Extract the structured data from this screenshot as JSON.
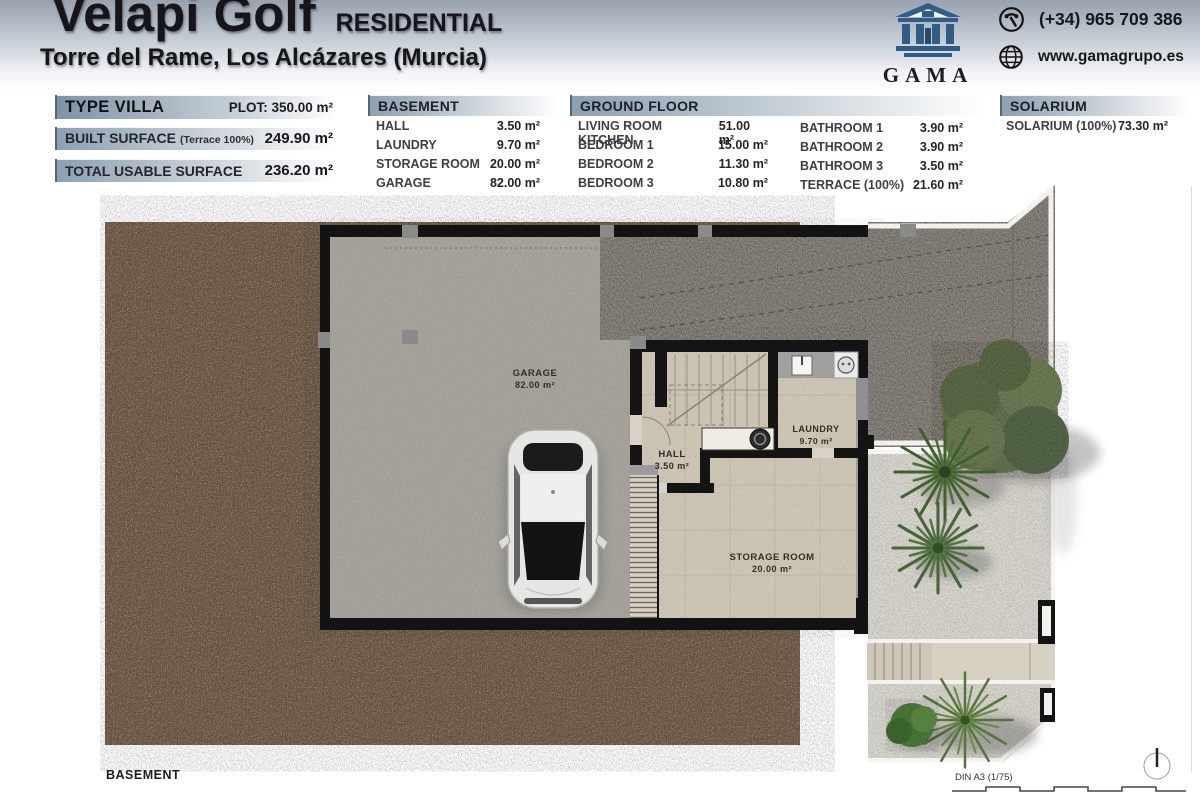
{
  "header": {
    "title": "Velapi Golf",
    "residential": "RESIDENTIAL",
    "subtitle": "Torre del Rame, Los Alcázares (Murcia)",
    "logo_text": "GAMA",
    "phone": "(+34) 965 709 386",
    "website": "www.gamagrupo.es"
  },
  "summary": {
    "type": "TYPE VILLA",
    "plot": "PLOT: 350.00 m²",
    "built_label": "BUILT SURFACE",
    "built_note": "(Terrace 100%)",
    "built_value": "249.90 m²",
    "usable_label": "TOTAL USABLE SURFACE",
    "usable_value": "236.20 m²"
  },
  "basement_table": {
    "title": "BASEMENT",
    "rows": [
      {
        "label": "HALL",
        "value": "3.50 m²"
      },
      {
        "label": "LAUNDRY",
        "value": "9.70 m²"
      },
      {
        "label": "STORAGE ROOM",
        "value": "20.00 m²"
      },
      {
        "label": "GARAGE",
        "value": "82.00 m²"
      }
    ]
  },
  "ground_table": {
    "title": "GROUND FLOOR",
    "col1": [
      {
        "label": "LIVING ROOM KITCHEN",
        "value": "51.00 m²"
      },
      {
        "label": "BEDROOM 1",
        "value": "15.00 m²"
      },
      {
        "label": "BEDROOM 2",
        "value": "11.30 m²"
      },
      {
        "label": "BEDROOM 3",
        "value": "10.80 m²"
      }
    ],
    "col2": [
      {
        "label": "BATHROOM 1",
        "value": "3.90 m²"
      },
      {
        "label": "BATHROOM 2",
        "value": "3.90 m²"
      },
      {
        "label": "BATHROOM 3",
        "value": "3.50 m²"
      },
      {
        "label": "TERRACE (100%)",
        "value": "21.60 m²"
      }
    ]
  },
  "solarium_table": {
    "title": "SOLARIUM",
    "rows": [
      {
        "label": "SOLARIUM (100%)",
        "value": "73.30 m²"
      }
    ]
  },
  "plan": {
    "garage_name": "GARAGE",
    "garage_area": "82.00 m²",
    "hall_name": "HALL",
    "hall_area": "3.50 m²",
    "laundry_name": "LAUNDRY",
    "laundry_area": "9.70 m²",
    "storage_name": "STORAGE ROOM",
    "storage_area": "20.00 m²",
    "floor_label": "BASEMENT",
    "scale_label": "DIN A3 (1/75)"
  },
  "colors": {
    "brand_blue": "#2f5d88",
    "header_gray": "#98a2ae",
    "soil_brown": "#6d5843",
    "garage_floor": "#a9a59e",
    "driveway": "#8e8880",
    "gravel": "#d7d4cc",
    "tile_beige": "#cfc7b6",
    "wall_black": "#141414"
  }
}
